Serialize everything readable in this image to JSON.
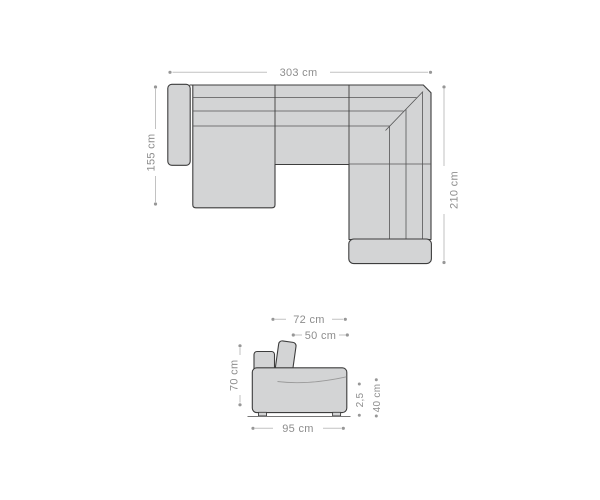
{
  "diagram_title": "sofa-dimension-drawing",
  "colors": {
    "background": "#ffffff",
    "sofa_fill": "#d3d4d5",
    "outline": "#3d3d3d",
    "seam": "#555555",
    "soft_seam": "#9a9a9a",
    "floor": "#777777",
    "dimension_line": "#c2c2c2",
    "dimension_marker": "#979797",
    "dimension_text": "#8d8d8d"
  },
  "top_view": {
    "width_label": "303 cm",
    "left_depth_label": "155 cm",
    "right_depth_label": "210 cm"
  },
  "side_view": {
    "total_depth_label": "72 cm",
    "seat_depth_label": "50 cm",
    "back_height_label": "70 cm",
    "base_depth_label": "95 cm",
    "foot_height_label": "2,5",
    "seat_height_label": "40 cm"
  }
}
